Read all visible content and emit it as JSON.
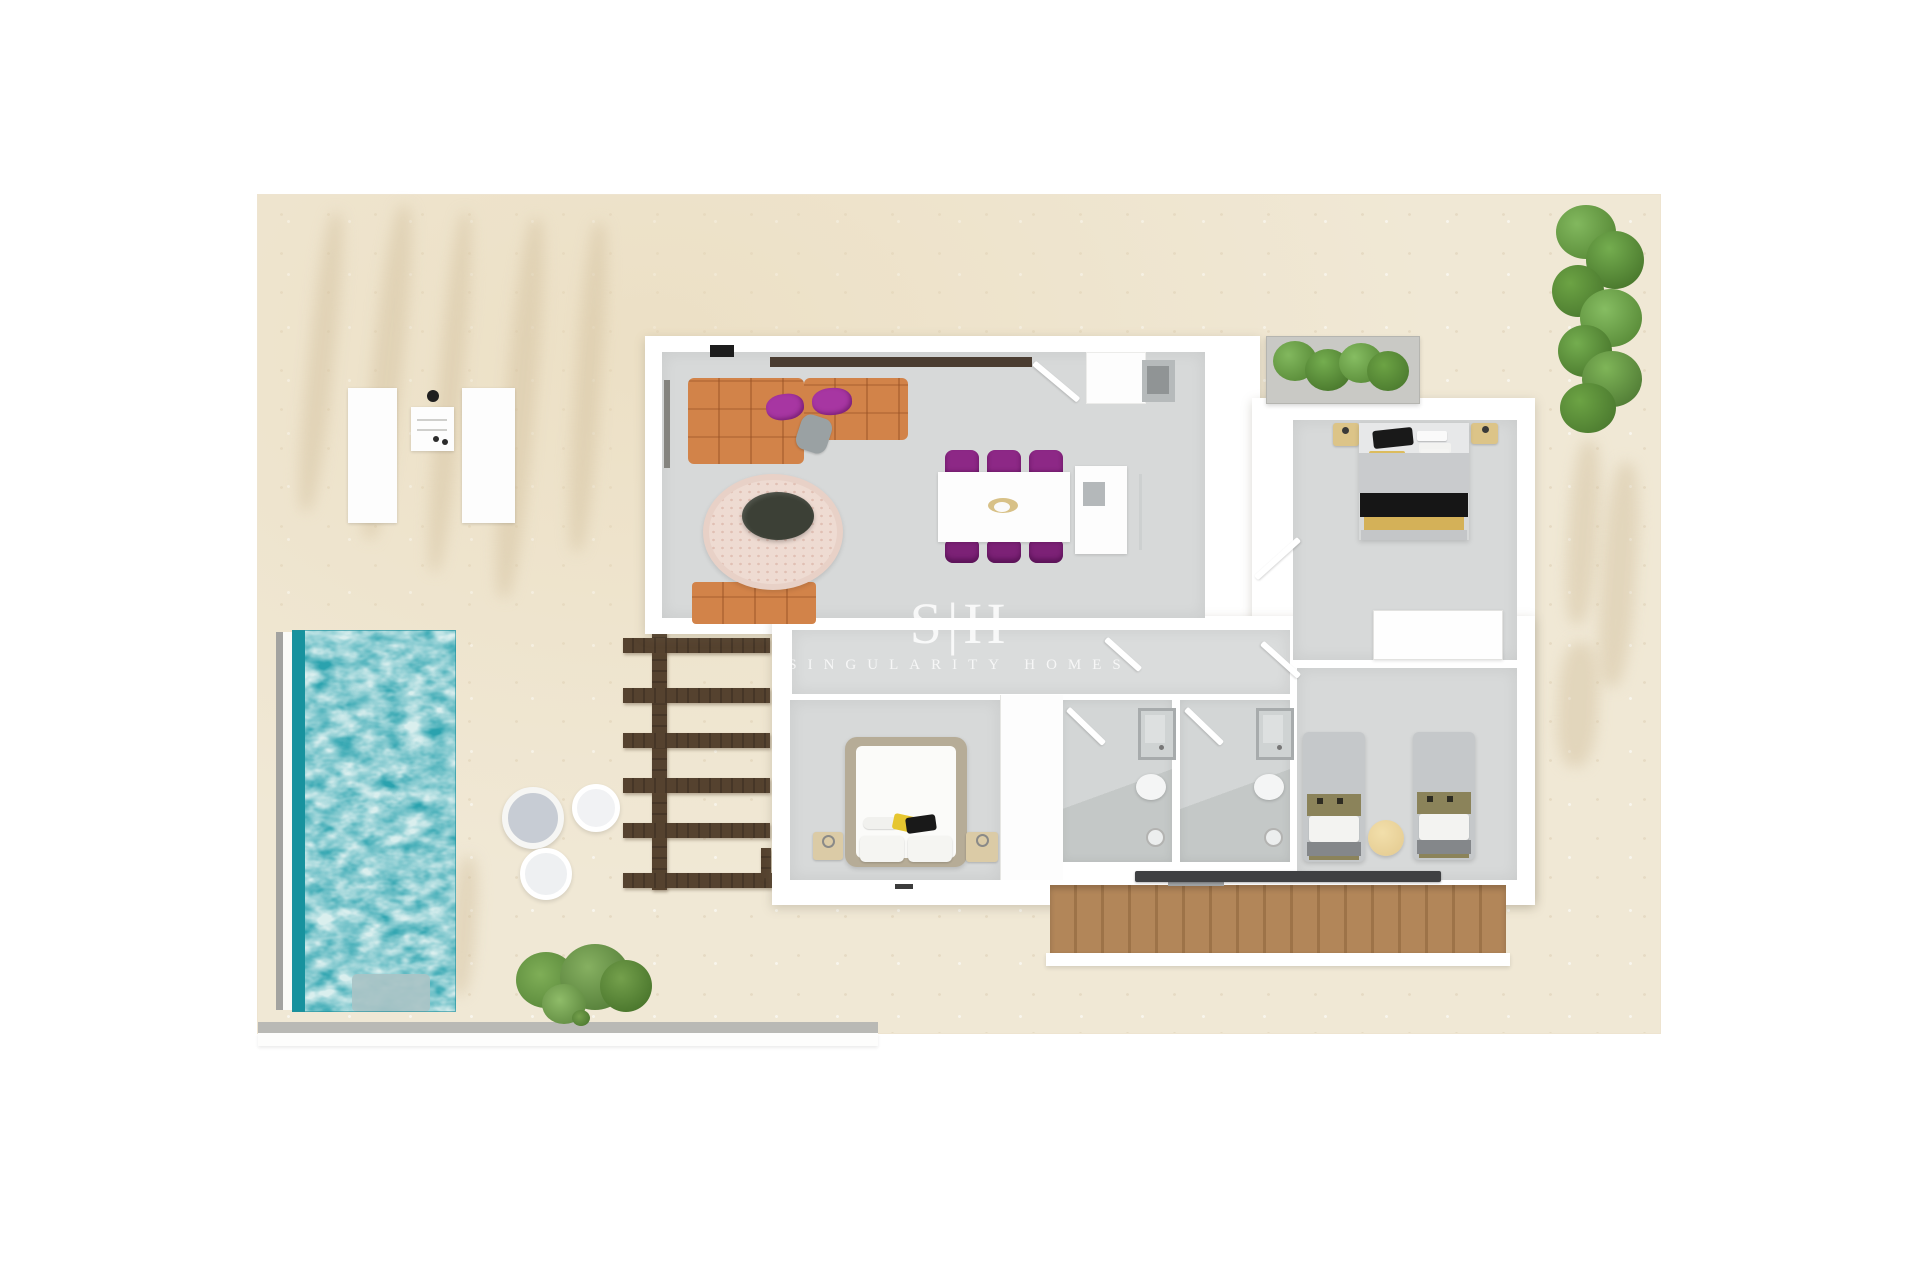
{
  "watermark": {
    "logo": "S|H",
    "subtitle": "SINGULARITY HOMES"
  },
  "palette": {
    "page_background": "#ffffff",
    "terrace": "#f0e8d5",
    "pool_water": "#2aa2ae",
    "pool_edge": "#17929e",
    "pool_step": "#a9c3c6",
    "wall_white": "#ffffff",
    "floor_grey": "#d7d9d9",
    "sofa_orange": "#d28349",
    "accent_purple": "#8d2886",
    "rug_pink": "#eedbd2",
    "coffee_table_dark": "#3c4036",
    "pergola_wood": "#55422f",
    "stairs_wood": "#b28659",
    "handrail_dark": "#3f4042",
    "plant_green": "#5f9c40",
    "bed_grey": "#c9cbcd",
    "throw_yellow": "#d4b158",
    "bed_frame_tan": "#b6ac97",
    "boundary_grey": "#b9b9b5"
  },
  "scene": {
    "type": "3d-rendered-floor-plan-top-view",
    "rooms": [
      "living-dining-area",
      "entrance-hall",
      "corridor",
      "bedroom-double-top-right",
      "bedroom-master-bottom-left",
      "bedroom-twin-bottom-right",
      "bathroom-1",
      "bathroom-2"
    ],
    "outdoor": [
      "terrace",
      "swimming-pool",
      "pool-steps",
      "pergola",
      "sun-loungers",
      "bbq-unit",
      "round-poufs",
      "staircase",
      "hedge-plants",
      "planter-box",
      "garden-bush"
    ],
    "furniture": [
      "l-shaped-sofa",
      "small-sofa",
      "round-rug",
      "coffee-table",
      "dining-table",
      "dining-chairs-x6",
      "sideboard-cabinet",
      "double-bed",
      "twin-beds",
      "master-bed",
      "nightstands",
      "wardrobe",
      "showers",
      "toilets"
    ]
  }
}
